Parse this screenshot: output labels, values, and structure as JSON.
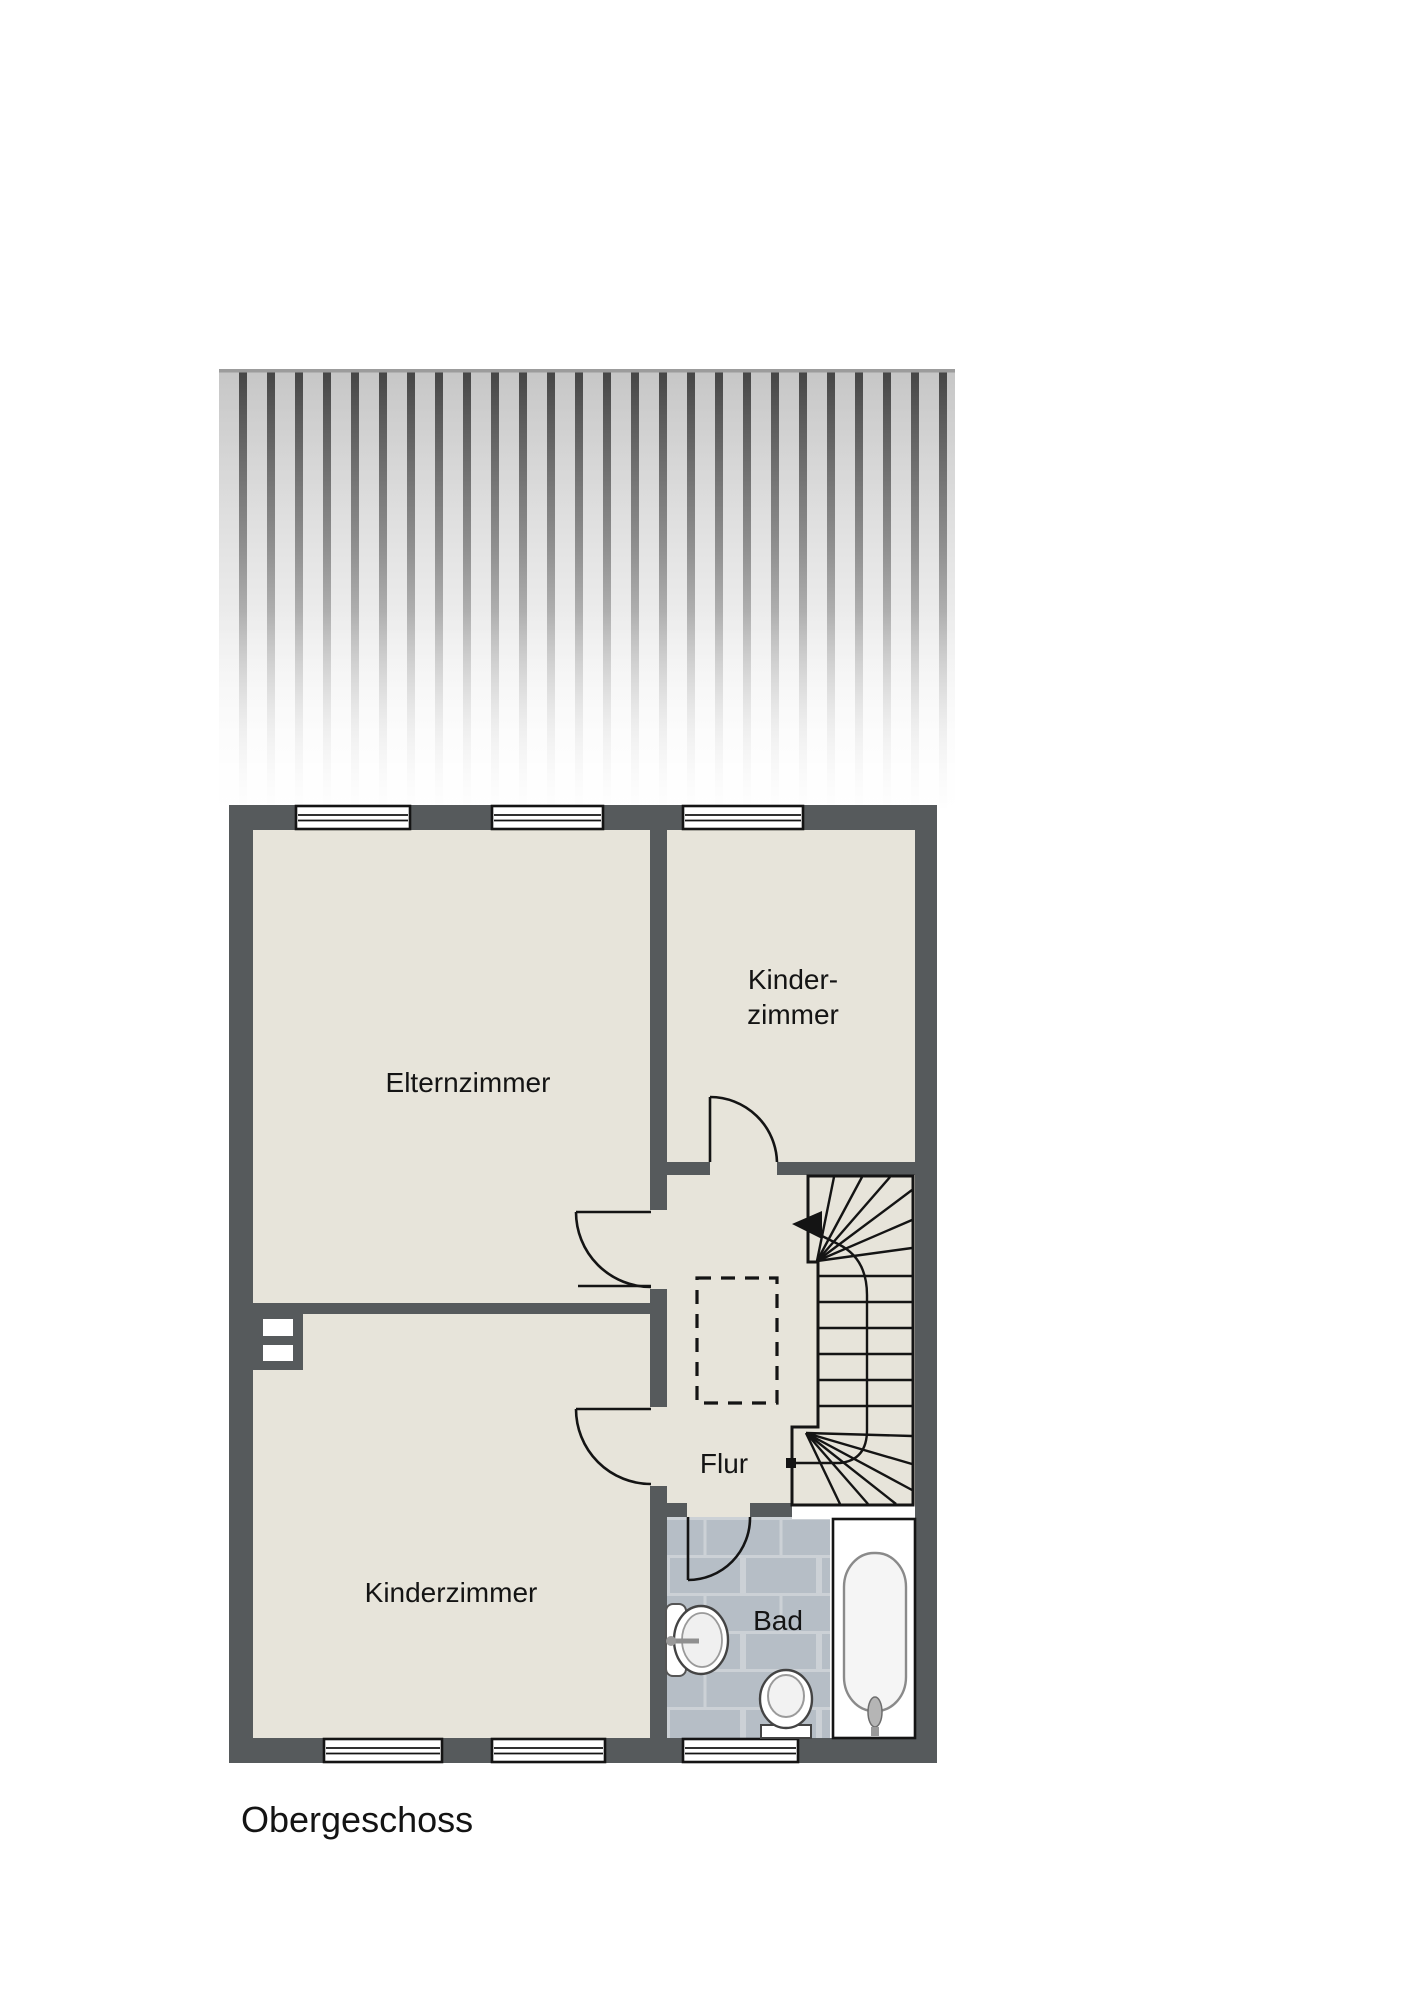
{
  "floor": {
    "label": "Obergeschoss"
  },
  "rooms": {
    "elternzimmer": {
      "label": "Elternzimmer"
    },
    "kinderzimmer_top": {
      "label_line1": "Kinder-",
      "label_line2": "zimmer"
    },
    "kinderzimmer_bottom": {
      "label": "Kinderzimmer"
    },
    "flur": {
      "label": "Flur"
    },
    "bad": {
      "label": "Bad"
    }
  },
  "fixtures": {
    "stairs": "winder-staircase-with-walking-line-arrow",
    "chimney": "dashed-shaft-outline",
    "bathtub": "bathtub",
    "sink": "washbasin",
    "toilet": "toilet",
    "vent": "wall-vent-double-slot",
    "window_count": 6,
    "door_count": 4
  },
  "colors": {
    "background": "#ffffff",
    "wall": "#565a5c",
    "floor": "#e7e4da",
    "bath_tile": "#b6bec6",
    "bath_grout": "#ccd1d6",
    "roof_stripe_light": "#c9c9c9",
    "roof_stripe_dark": "#4a4a4a",
    "outline": "#141414"
  }
}
